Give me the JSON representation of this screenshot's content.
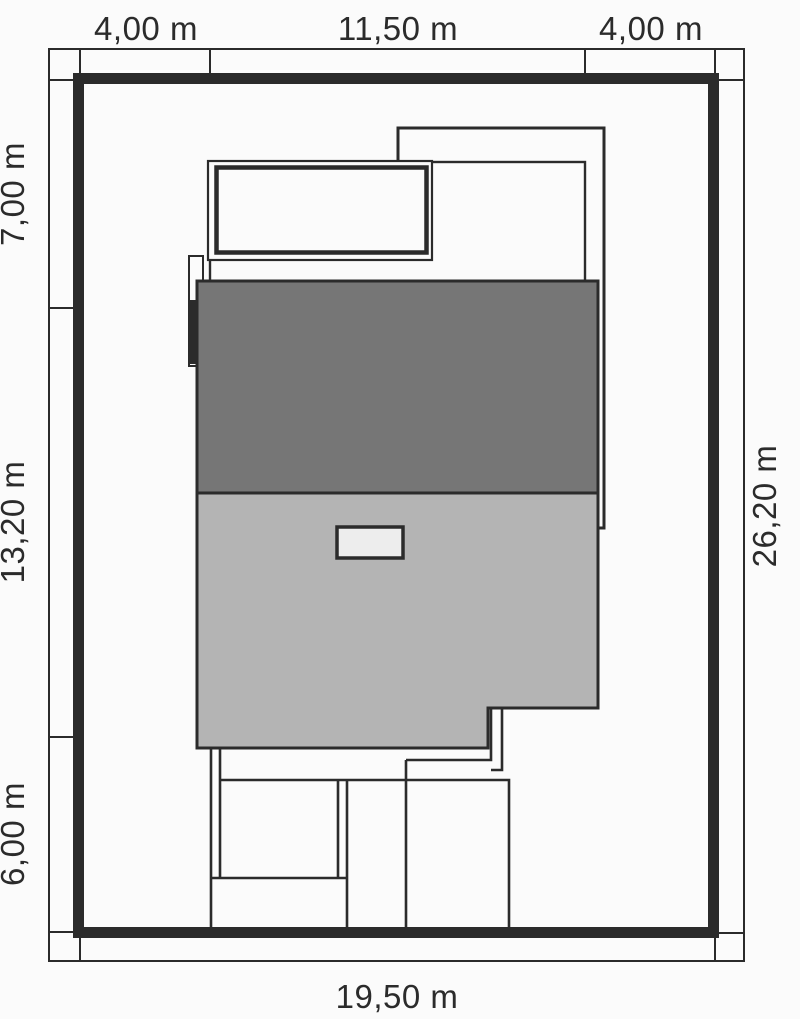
{
  "title": "House plot site plan",
  "dimensions": {
    "top": [
      "4,00 m",
      "11,50 m",
      "4,00 m"
    ],
    "left": [
      "7,00 m",
      "13,20 m",
      "6,00 m"
    ],
    "right": [
      "26,20 m"
    ],
    "bottom": [
      "19,50 m"
    ]
  },
  "colors": {
    "background": "#fbfbfb",
    "line": "#2b2b2b",
    "roof_upper": "#767676",
    "roof_lower": "#b4b4b4",
    "skylight": "#ededed",
    "white_fill": "#fbfbfb"
  }
}
